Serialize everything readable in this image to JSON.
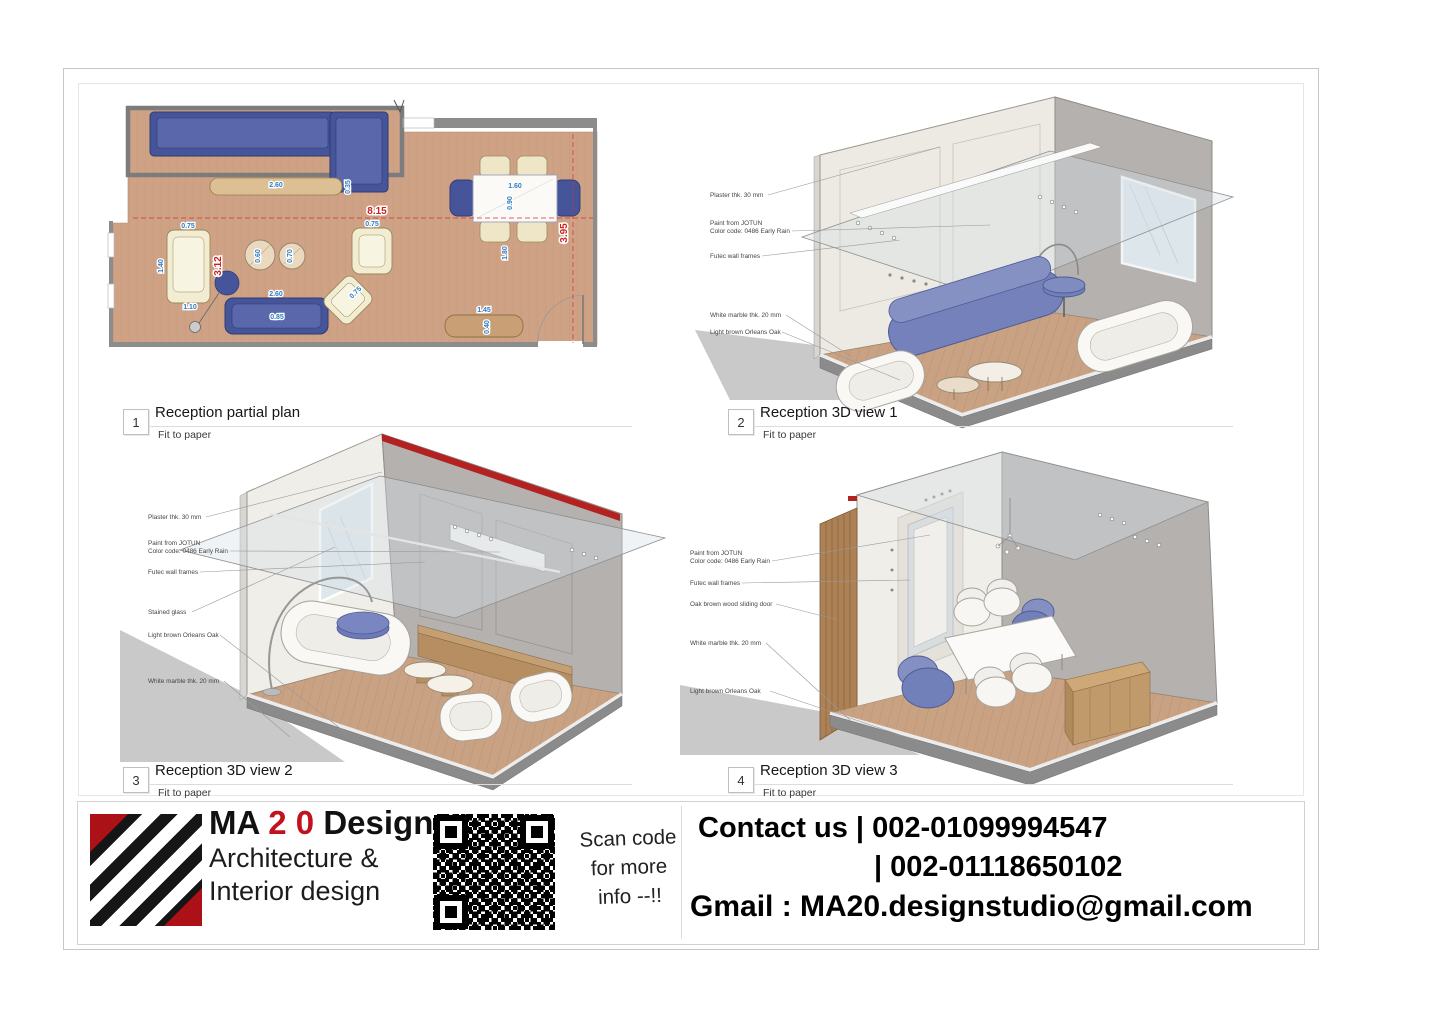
{
  "views": [
    {
      "number": "1",
      "title": "Reception partial plan",
      "subtitle": "Fit to paper"
    },
    {
      "number": "2",
      "title": "Reception 3D view 1",
      "subtitle": "Fit to paper"
    },
    {
      "number": "3",
      "title": "Reception 3D view 2",
      "subtitle": "Fit to paper"
    },
    {
      "number": "4",
      "title": "Reception 3D view 3",
      "subtitle": "Fit to paper"
    }
  ],
  "annotations": {
    "plaster": "Plaster thk. 30 mm",
    "paint_line1": "Paint from JOTUN",
    "paint_line2": "Color code: 0486 Early Rain",
    "futec": "Futec wall frames",
    "white_marble": "White marble thk. 20 mm",
    "orleans_oak": "Light brown Orleans Oak",
    "stained_glass": "Stained glass",
    "sliding_door": "Oak brown wood sliding door"
  },
  "plan_dims": {
    "overall_width": "8.15",
    "overall_depth": "3.95",
    "left_zone": "3.12",
    "table_w": "1.60",
    "table_d": "0.90",
    "clear_walk": "1.80",
    "sofa_len": "2.60",
    "sofa_d": "0.85",
    "console_d": "0.35",
    "chair_w": "0.75",
    "chaise_l": "1.40",
    "chaise_b": "1.10",
    "pouf_1": "0.60",
    "pouf_2": "0.70",
    "bench_l": "1.45",
    "bench_d": "0.40"
  },
  "titleblock": {
    "brand_ma": "MA",
    "brand_20": "2 0",
    "brand_designs": "Designs",
    "tagline_line1": "Architecture &",
    "tagline_line2": "Interior design",
    "scan_line1": "Scan code",
    "scan_line2": "for more",
    "scan_line3": "info --!!",
    "contact_line1": "Contact us | 002-01099994547",
    "contact_line2": "| 002-01118650102",
    "contact_line3": "Gmail : MA20.designstudio@gmail.com"
  },
  "colors": {
    "accent_red": "#c1121f",
    "beam_red": "#b32121",
    "furniture_blue_3d": "#7380b8",
    "furniture_navy_plan": "#46549a",
    "dim_blue": "#2f7bc0",
    "dim_red": "#cc2222",
    "wood_floor": "#c9a183",
    "wall_gray": "#b4b1ae",
    "wall_cream": "#edeae3"
  }
}
